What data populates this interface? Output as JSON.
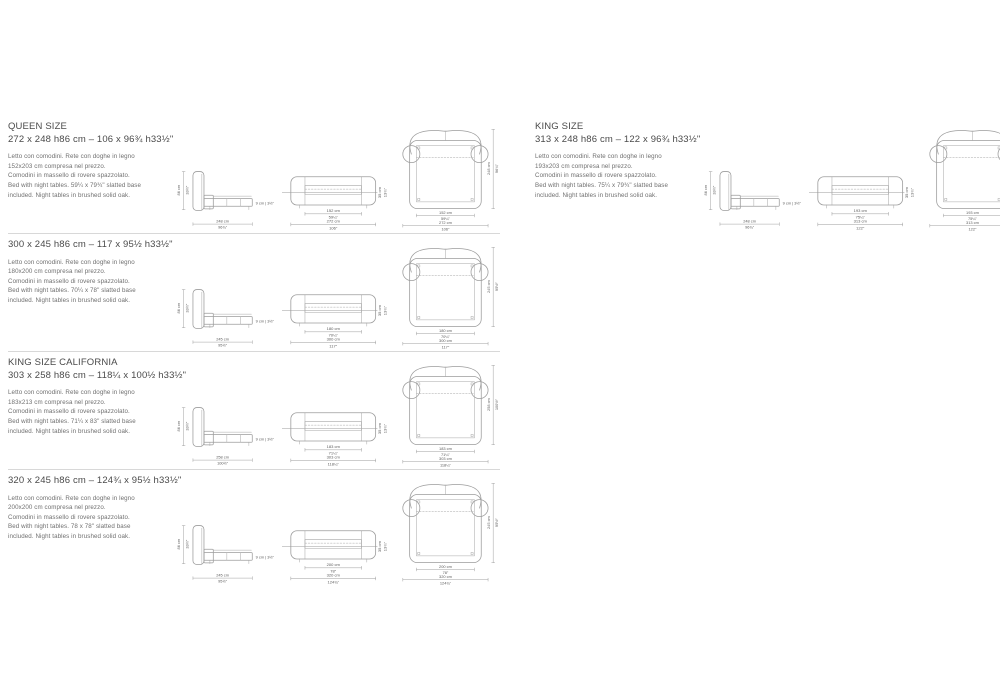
{
  "page": {
    "background": "#ffffff",
    "line_color": "#9c9c9c",
    "title_color": "#4a4a4a",
    "desc_color": "#6f6f6f",
    "separator_color": "#d8d8d8"
  },
  "sections": [
    {
      "title": "QUEEN SIZE",
      "dimensions": "272 x 248 h86 cm – 106 x 96¾ h33½\"",
      "desc": [
        "Letto con comodini. Rete con doghe in legno",
        "152x203 cm compresa nel prezzo.",
        "Comodini in massello di rovere spazzolato.",
        "Bed with night tables. 59¼ x 79¾\" slatted base",
        "included. Night tables in brushed solid oak."
      ],
      "labels": {
        "height": {
          "cm": "86 cm",
          "in": "33½\""
        },
        "length": {
          "cm": "248 cm",
          "in": "96¾\""
        },
        "clearance": "9 cm | 3½\"",
        "rail": {
          "cm": "35 cm",
          "in": "13¾\""
        },
        "mattress": {
          "cm": "152 cm",
          "in": "59¼\""
        },
        "overall": {
          "cm": "272 cm",
          "in": "106\""
        },
        "depth": {
          "cm": "248 cm",
          "in": "96¾\""
        }
      }
    },
    {
      "title": "",
      "dimensions": "300 x 245 h86 cm – 117 x 95½ h33½\"",
      "desc": [
        "Letto con comodini. Rete con doghe in legno",
        "180x200 cm compresa nel prezzo.",
        "Comodini in massello di rovere spazzolato.",
        "Bed with night tables. 70¼ x 78\" slatted base",
        "included. Night tables in brushed solid oak."
      ],
      "labels": {
        "height": {
          "cm": "86 cm",
          "in": "33½\""
        },
        "length": {
          "cm": "245 cm",
          "in": "95½\""
        },
        "clearance": "9 cm | 3½\"",
        "rail": {
          "cm": "35 cm",
          "in": "13¾\""
        },
        "mattress": {
          "cm": "180 cm",
          "in": "70¼\""
        },
        "overall": {
          "cm": "300 cm",
          "in": "117\""
        },
        "depth": {
          "cm": "245 cm",
          "in": "95½\""
        }
      }
    },
    {
      "title": "KING SIZE CALIFORNIA",
      "dimensions": "303 x 258 h86 cm – 118¼ x 100½ h33½\"",
      "desc": [
        "Letto con comodini. Rete con doghe in legno",
        "183x213 cm compresa nel prezzo.",
        "Comodini in massello di rovere spazzolato.",
        "Bed with night tables. 71¼ x 83\" slatted base",
        "included. Night tables in brushed solid oak."
      ],
      "labels": {
        "height": {
          "cm": "86 cm",
          "in": "33½\""
        },
        "length": {
          "cm": "258 cm",
          "in": "100½\""
        },
        "clearance": "9 cm | 3½\"",
        "rail": {
          "cm": "35 cm",
          "in": "13¾\""
        },
        "mattress": {
          "cm": "183 cm",
          "in": "71¼\""
        },
        "overall": {
          "cm": "303 cm",
          "in": "118¼\""
        },
        "depth": {
          "cm": "258 cm",
          "in": "100½\""
        }
      }
    },
    {
      "title": "",
      "dimensions": "320 x 245 h86 cm – 124¾ x 95½ h33½\"",
      "desc": [
        "Letto con comodini. Rete con doghe in legno",
        "200x200 cm compresa nel prezzo.",
        "Comodini in massello di rovere spazzolato.",
        "Bed with night tables. 78 x 78\" slatted base",
        "included. Night tables in brushed solid oak."
      ],
      "labels": {
        "height": {
          "cm": "86 cm",
          "in": "33½\""
        },
        "length": {
          "cm": "245 cm",
          "in": "95½\""
        },
        "clearance": "9 cm | 3½\"",
        "rail": {
          "cm": "35 cm",
          "in": "13¾\""
        },
        "mattress": {
          "cm": "200 cm",
          "in": "78\""
        },
        "overall": {
          "cm": "320 cm",
          "in": "124¾\""
        },
        "depth": {
          "cm": "245 cm",
          "in": "95½\""
        }
      }
    },
    {
      "title": "KING SIZE",
      "dimensions": "313 x 248 h86 cm – 122 x 96¾ h33½\"",
      "desc": [
        "Letto con comodini. Rete con doghe in legno",
        "193x203 cm compresa nel prezzo.",
        "Comodini in massello di rovere spazzolato.",
        "Bed with night tables. 75¼ x 79¾\" slatted base",
        "included. Night tables in brushed solid oak."
      ],
      "labels": {
        "height": {
          "cm": "86 cm",
          "in": "33½\""
        },
        "length": {
          "cm": "248 cm",
          "in": "96¾\""
        },
        "clearance": "9 cm | 3½\"",
        "rail": {
          "cm": "35 cm",
          "in": "13¾\""
        },
        "mattress": {
          "cm": "193 cm",
          "in": "75¼\""
        },
        "overall": {
          "cm": "313 cm",
          "in": "122\""
        },
        "depth": {
          "cm": "248 cm",
          "in": "96¾\""
        }
      }
    }
  ]
}
